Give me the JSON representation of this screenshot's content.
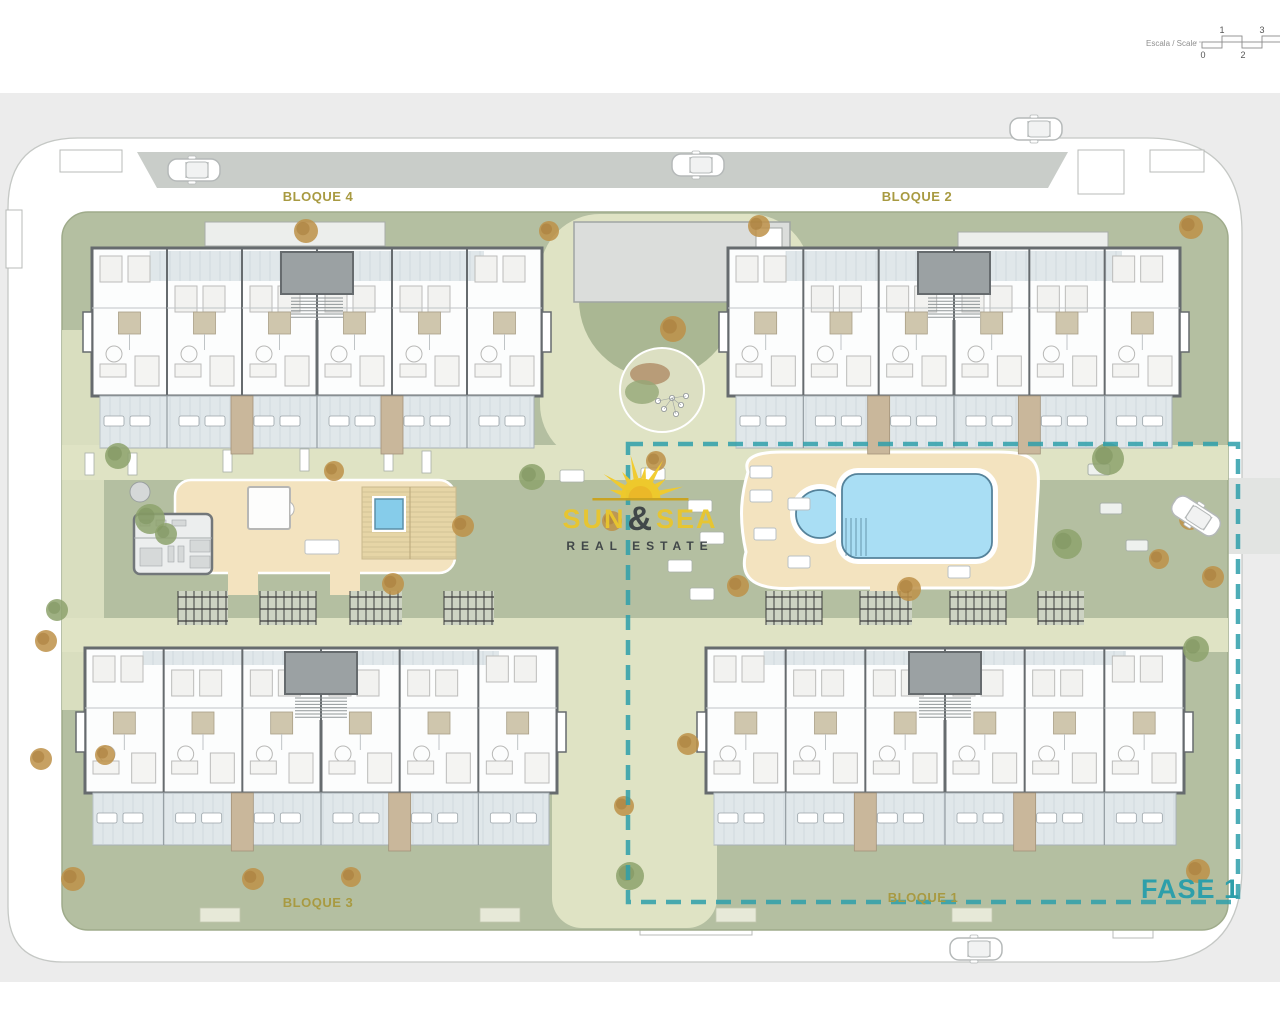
{
  "title": "Residential development site plan",
  "scale_bar": {
    "label": "Escala / Scale",
    "ticks": [
      "0",
      "1",
      "2",
      "3"
    ]
  },
  "blocks": [
    {
      "id": "bloque-4",
      "label": "BLOQUE 4"
    },
    {
      "id": "bloque-2",
      "label": "BLOQUE 2"
    },
    {
      "id": "bloque-3",
      "label": "BLOQUE 3"
    },
    {
      "id": "bloque-1",
      "label": "BLOQUE 1"
    }
  ],
  "phase": {
    "label": "FASE 1"
  },
  "logo": {
    "word1": "SUN",
    "amp": "&",
    "word2": "SEA",
    "line2": "REAL ESTATE",
    "icon": "sun-rays-icon"
  },
  "features": {
    "pool": "swimming-pool",
    "kids_pool": "round-kids-pool",
    "spa": "spa-plunge-pool",
    "deck": "pool-sun-deck",
    "timber_deck": "timber-deck",
    "gym": "gym-pavilion",
    "playground": "playground-circle",
    "pergolas": "parking-pergolas",
    "cars": "car",
    "trees": "tree"
  },
  "colors": {
    "backdrop": "#ececec",
    "ring_fill": "#ffffff",
    "outline": "#c5c8c5",
    "road_band": "#c9cdc9",
    "site_grass": "#b4bfa1",
    "site_edge": "#9fab8b",
    "path": "#dfe3c4",
    "grass_dark": "#aab793",
    "building_wall": "#666b6e",
    "room_fill": "#fcfdfd",
    "terrace": "#e0e7ea",
    "terrace_line": "#c6d0d5",
    "bath": "#cfc6ad",
    "walkway": "#c9b79b",
    "stair_core": "#9ba1a3",
    "deck": "#f3e3bf",
    "wood": "#e6d5a6",
    "pool": "#a9def4",
    "pool_edge": "#55839b",
    "spa": "#86ccea",
    "gym": "#eceeee",
    "pergola": "#3c3c3c",
    "tree_green": "#8da26c",
    "tree_autumn": "#bd9148",
    "label_olive": "#a89a41",
    "fase_teal": "#2e9faa",
    "logo_yellow": "#e9c62e",
    "logo_dark": "#3d4346",
    "car_fill": "#ffffff",
    "car_stroke": "#b5b9b9"
  }
}
